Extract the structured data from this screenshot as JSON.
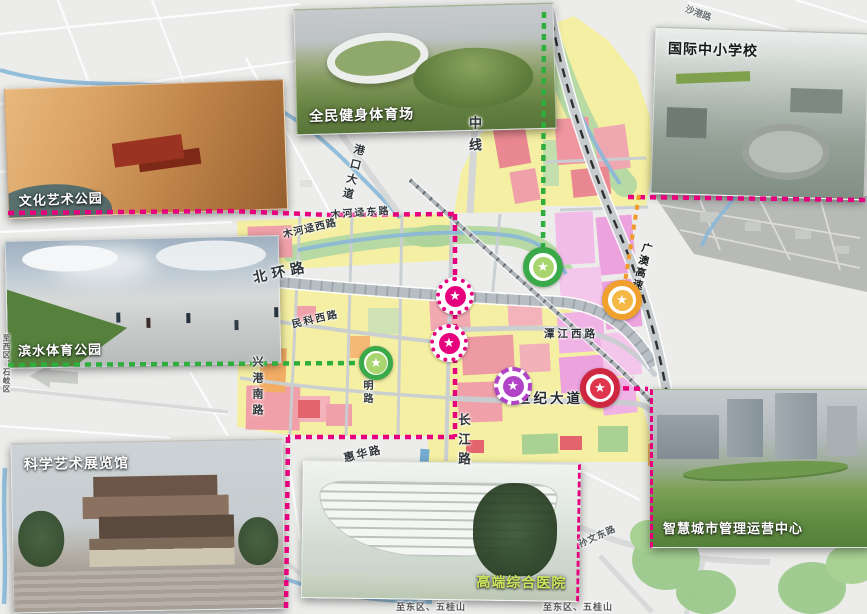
{
  "page": {
    "type": "urban-masterplan-map"
  },
  "icons": {
    "star": "★"
  },
  "insets": {
    "culture_park": {
      "label": "文化艺术公园"
    },
    "stadium": {
      "label": "全民健身体育场"
    },
    "school": {
      "label": "国际中小学校"
    },
    "waterfront_park": {
      "label": "滨水体育公园"
    },
    "science_museum": {
      "label": "科学艺术展览馆"
    },
    "hospital": {
      "label": "高端综合医院"
    },
    "smart_city": {
      "label": "智慧城市管理运营中心"
    }
  },
  "road_labels": {
    "zhongxian": "中线",
    "gangkou_avenue": "港口大道",
    "muhejing_east_road": "木河迳东路",
    "muhejing_west_road": "木河迳西路",
    "beihuan_road": "北环路",
    "minke_west_road": "民科西路",
    "xinggang_south_road": "兴港南路",
    "ming_road": "明路",
    "tanjiang_west_road": "潭江西路",
    "century_avenue": "世纪大道",
    "changjiang_road": "长江路",
    "huihua_road": "惠华路",
    "sunwen_east_road": "孙文东路",
    "guangao_expressway": "广澳高速",
    "shagang_road": "沙港路"
  },
  "directions": {
    "to_west": "至西区、石岐区",
    "to_east_south": "至东区、五桂山",
    "to_east_southeast": "至东区、五桂山"
  },
  "markers": [
    {
      "id": "facility-star-magenta-1",
      "ring": "dotted",
      "color": "#e6007d"
    },
    {
      "id": "facility-star-magenta-2",
      "ring": "dotted",
      "color": "#e6007d"
    },
    {
      "id": "facility-star-purple",
      "ring": "dashed",
      "color": "#b143c7"
    },
    {
      "id": "facility-star-green-1",
      "ring": "solid",
      "color": "#3aa94a"
    },
    {
      "id": "facility-star-green-2",
      "ring": "solid",
      "color": "#3aa94a"
    },
    {
      "id": "facility-star-orange",
      "ring": "solid",
      "color": "#f0a02c"
    },
    {
      "id": "facility-star-red",
      "ring": "solid",
      "color": "#cf2740"
    }
  ],
  "colors": {
    "boundary_magenta": "#e6007d",
    "boundary_green": "#2fae3e",
    "boundary_orange": "#f09a2a",
    "parcel_yellow": "#f4efa2",
    "parcel_pink": "#f0a0a8",
    "parcel_orange": "#f2ac64",
    "parcel_magenta": "#eba2dd",
    "parcel_green": "#b7daa4",
    "water_blue": "#8ab8d8"
  }
}
